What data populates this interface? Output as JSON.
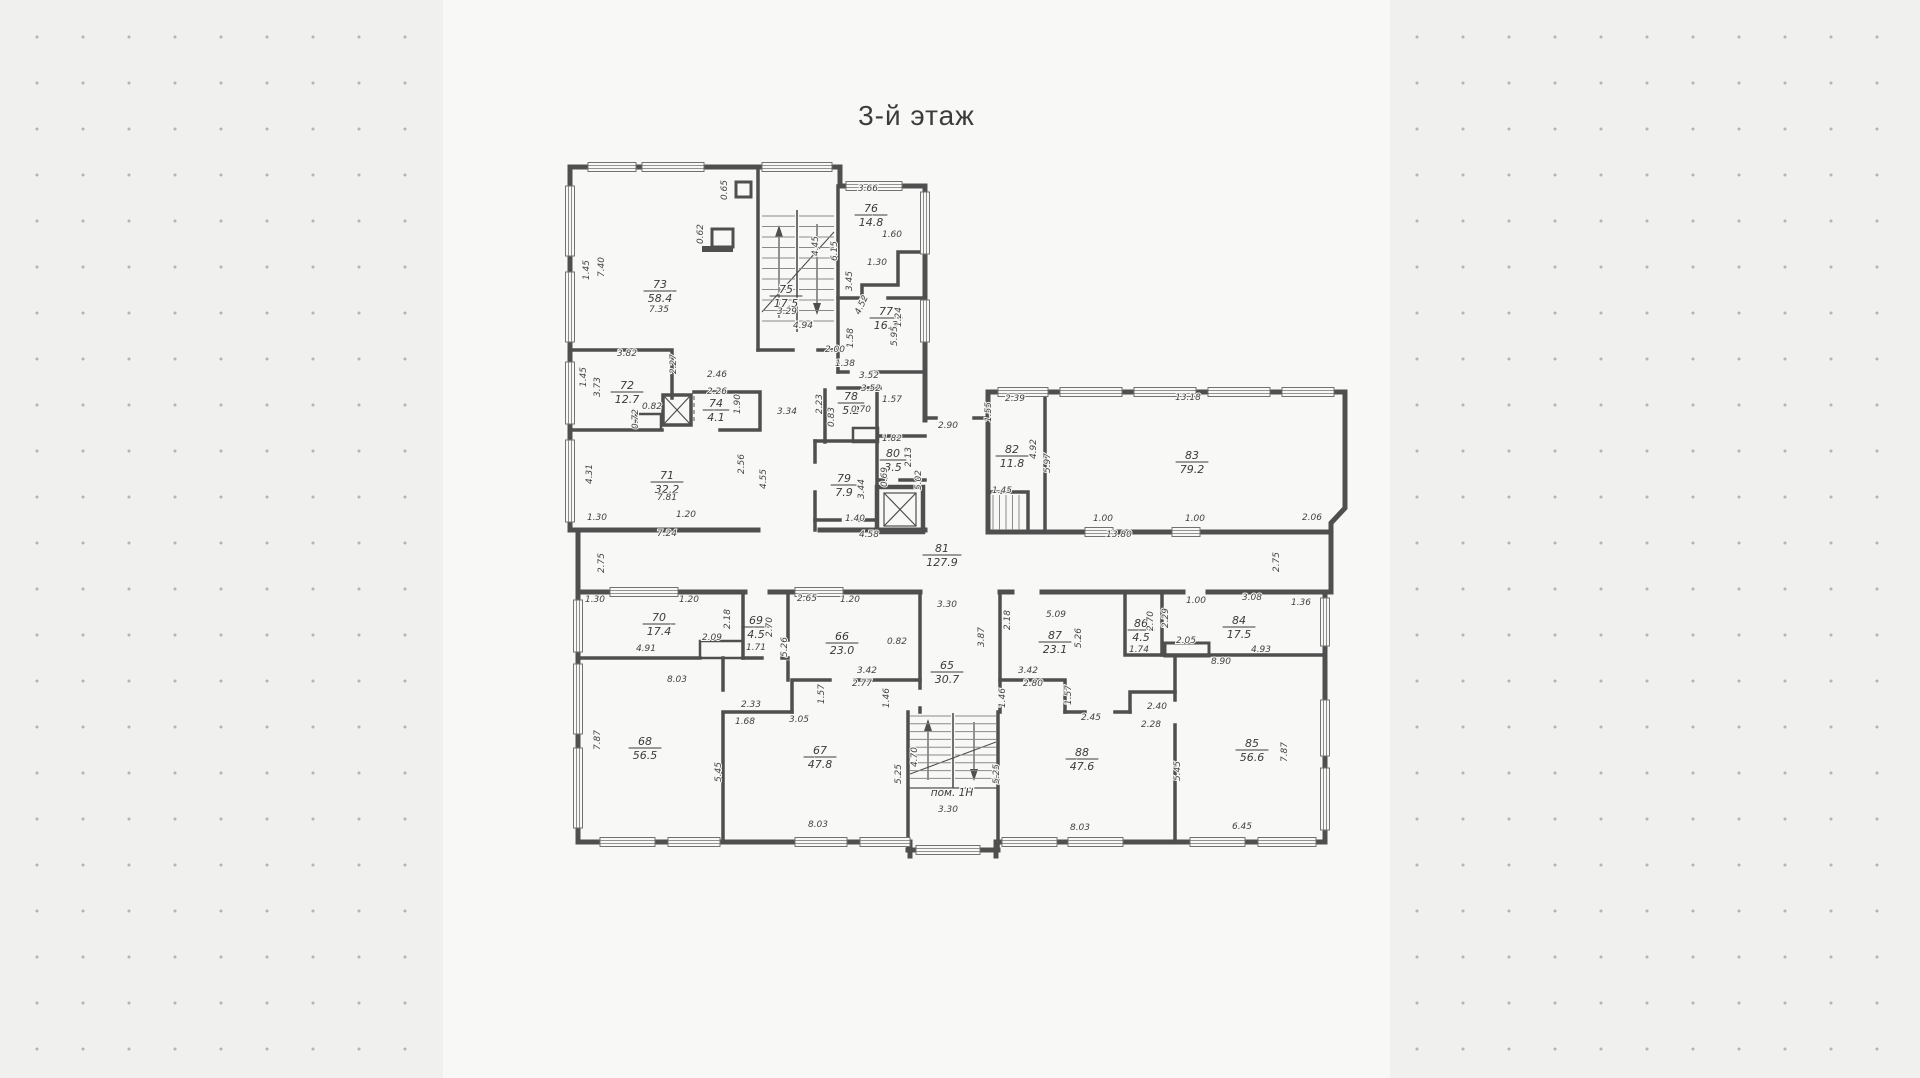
{
  "title": "3-й этаж",
  "colors": {
    "background": "#f0f0ee",
    "sheet": "#f8f8f7",
    "wall": "#4f4f4f",
    "thin_line": "#8a8a86",
    "text": "#45423e",
    "dot": "#b6b6b1"
  },
  "plan": {
    "rooms": [
      {
        "number": "73",
        "area": "58.4",
        "x": 660,
        "y": 288
      },
      {
        "number": "75",
        "area": "17.5",
        "x": 786,
        "y": 293
      },
      {
        "number": "76",
        "area": "14.8",
        "x": 871,
        "y": 212
      },
      {
        "number": "77",
        "area": "16.3",
        "x": 886,
        "y": 315
      },
      {
        "number": "72",
        "area": "12.7",
        "x": 627,
        "y": 389
      },
      {
        "number": "74",
        "area": "4.1",
        "x": 716,
        "y": 407
      },
      {
        "number": "71",
        "area": "32.2",
        "x": 667,
        "y": 479
      },
      {
        "number": "78",
        "area": "5.2",
        "x": 851,
        "y": 400
      },
      {
        "number": "80",
        "area": "3.5",
        "x": 893,
        "y": 457
      },
      {
        "number": "79",
        "area": "7.9",
        "x": 844,
        "y": 482
      },
      {
        "number": "82",
        "area": "11.8",
        "x": 1012,
        "y": 453
      },
      {
        "number": "83",
        "area": "79.2",
        "x": 1192,
        "y": 459
      },
      {
        "number": "81",
        "area": "127.9",
        "x": 942,
        "y": 552
      },
      {
        "number": "70",
        "area": "17.4",
        "x": 659,
        "y": 621
      },
      {
        "number": "69",
        "area": "4.5",
        "x": 756,
        "y": 624
      },
      {
        "number": "66",
        "area": "23.0",
        "x": 842,
        "y": 640
      },
      {
        "number": "65",
        "area": "30.7",
        "x": 947,
        "y": 669
      },
      {
        "number": "87",
        "area": "23.1",
        "x": 1055,
        "y": 639
      },
      {
        "number": "86",
        "area": "4.5",
        "x": 1141,
        "y": 627
      },
      {
        "number": "84",
        "area": "17.5",
        "x": 1239,
        "y": 624
      },
      {
        "number": "68",
        "area": "56.5",
        "x": 645,
        "y": 745
      },
      {
        "number": "67",
        "area": "47.8",
        "x": 820,
        "y": 754
      },
      {
        "number": "88",
        "area": "47.6",
        "x": 1082,
        "y": 756
      },
      {
        "number": "85",
        "area": "56.6",
        "x": 1252,
        "y": 747
      }
    ],
    "stair_room": {
      "label": "пом. 1Н",
      "x": 952,
      "y": 796
    },
    "dims": [
      {
        "t": "0.65",
        "x": 727,
        "y": 190,
        "r": -90
      },
      {
        "t": "0.62",
        "x": 703,
        "y": 234,
        "r": -90
      },
      {
        "t": "7.35",
        "x": 659,
        "y": 312
      },
      {
        "t": "3.82",
        "x": 627,
        "y": 356
      },
      {
        "t": "1.45",
        "x": 589,
        "y": 270,
        "r": -90
      },
      {
        "t": "7.40",
        "x": 604,
        "y": 267,
        "r": -90
      },
      {
        "t": "3.29",
        "x": 787,
        "y": 314
      },
      {
        "t": "4.94",
        "x": 803,
        "y": 328
      },
      {
        "t": "3.66",
        "x": 868,
        "y": 191
      },
      {
        "t": "1.60",
        "x": 892,
        "y": 237
      },
      {
        "t": "6.15",
        "x": 837,
        "y": 251,
        "r": -90
      },
      {
        "t": "1.30",
        "x": 877,
        "y": 265
      },
      {
        "t": "3.45",
        "x": 852,
        "y": 281,
        "r": -90
      },
      {
        "t": "4.52",
        "x": 864,
        "y": 306,
        "r": -65
      },
      {
        "t": "1.24",
        "x": 901,
        "y": 317,
        "r": -90
      },
      {
        "t": "5.95",
        "x": 897,
        "y": 336,
        "r": -90
      },
      {
        "t": "4.45",
        "x": 818,
        "y": 246,
        "r": -90
      },
      {
        "t": "1.45",
        "x": 586,
        "y": 377,
        "r": -90
      },
      {
        "t": "3.73",
        "x": 600,
        "y": 387,
        "r": -90
      },
      {
        "t": "2.27",
        "x": 676,
        "y": 364,
        "r": -90
      },
      {
        "t": "2.46",
        "x": 717,
        "y": 377
      },
      {
        "t": "2.26",
        "x": 717,
        "y": 394
      },
      {
        "t": "1.90",
        "x": 740,
        "y": 404,
        "r": -90
      },
      {
        "t": "0.82",
        "x": 652,
        "y": 409
      },
      {
        "t": "0.72",
        "x": 638,
        "y": 419,
        "r": -90
      },
      {
        "t": "3.34",
        "x": 787,
        "y": 414
      },
      {
        "t": "2.23",
        "x": 822,
        "y": 404,
        "r": -90
      },
      {
        "t": "2.00",
        "x": 835,
        "y": 352
      },
      {
        "t": "1.38",
        "x": 845,
        "y": 366
      },
      {
        "t": "1.58",
        "x": 853,
        "y": 338,
        "r": -90
      },
      {
        "t": "3.52",
        "x": 869,
        "y": 378
      },
      {
        "t": "3.52",
        "x": 871,
        "y": 391
      },
      {
        "t": "1.57",
        "x": 892,
        "y": 402
      },
      {
        "t": "0.70",
        "x": 861,
        "y": 412
      },
      {
        "t": "0.83",
        "x": 834,
        "y": 417,
        "r": -90
      },
      {
        "t": "1.82",
        "x": 892,
        "y": 441
      },
      {
        "t": "2.13",
        "x": 911,
        "y": 457,
        "r": -90
      },
      {
        "t": "0.69",
        "x": 887,
        "y": 477,
        "r": -90
      },
      {
        "t": "5.02",
        "x": 921,
        "y": 480,
        "r": -90
      },
      {
        "t": "3.44",
        "x": 864,
        "y": 489,
        "r": -90
      },
      {
        "t": "1.40",
        "x": 855,
        "y": 521
      },
      {
        "t": "4.58",
        "x": 869,
        "y": 537
      },
      {
        "t": "2.90",
        "x": 948,
        "y": 428
      },
      {
        "t": "1.55",
        "x": 991,
        "y": 412,
        "r": -90
      },
      {
        "t": "4.31",
        "x": 592,
        "y": 474,
        "r": -90
      },
      {
        "t": "7.81",
        "x": 667,
        "y": 500
      },
      {
        "t": "1.30",
        "x": 597,
        "y": 520
      },
      {
        "t": "1.20",
        "x": 686,
        "y": 517
      },
      {
        "t": "7.24",
        "x": 667,
        "y": 536
      },
      {
        "t": "2.56",
        "x": 744,
        "y": 464,
        "r": -90
      },
      {
        "t": "4.55",
        "x": 766,
        "y": 479,
        "r": -90
      },
      {
        "t": "2.75",
        "x": 604,
        "y": 563,
        "r": -90
      },
      {
        "t": "2.39",
        "x": 1015,
        "y": 401
      },
      {
        "t": "13.18",
        "x": 1188,
        "y": 400
      },
      {
        "t": "4.92",
        "x": 1036,
        "y": 449,
        "r": -90
      },
      {
        "t": "5.97",
        "x": 1050,
        "y": 463,
        "r": -90
      },
      {
        "t": "1.45",
        "x": 1002,
        "y": 493
      },
      {
        "t": "1.00",
        "x": 1103,
        "y": 521
      },
      {
        "t": "1.00",
        "x": 1195,
        "y": 521
      },
      {
        "t": "13.80",
        "x": 1119,
        "y": 537
      },
      {
        "t": "2.06",
        "x": 1312,
        "y": 520
      },
      {
        "t": "2.75",
        "x": 1279,
        "y": 562,
        "r": -90
      },
      {
        "t": "1.30",
        "x": 595,
        "y": 602
      },
      {
        "t": "1.20",
        "x": 689,
        "y": 602
      },
      {
        "t": "2.65",
        "x": 807,
        "y": 601
      },
      {
        "t": "1.20",
        "x": 850,
        "y": 602
      },
      {
        "t": "3.30",
        "x": 947,
        "y": 607
      },
      {
        "t": "2.18",
        "x": 730,
        "y": 619,
        "r": -90
      },
      {
        "t": "2.09",
        "x": 712,
        "y": 640
      },
      {
        "t": "4.91",
        "x": 646,
        "y": 651
      },
      {
        "t": "8.03",
        "x": 677,
        "y": 682
      },
      {
        "t": "2.70",
        "x": 772,
        "y": 627,
        "r": -90
      },
      {
        "t": "1.71",
        "x": 756,
        "y": 650
      },
      {
        "t": "5.26",
        "x": 787,
        "y": 647,
        "r": -90
      },
      {
        "t": "0.82",
        "x": 897,
        "y": 644
      },
      {
        "t": "1.57",
        "x": 824,
        "y": 694,
        "r": -90
      },
      {
        "t": "3.42",
        "x": 867,
        "y": 673
      },
      {
        "t": "2.77",
        "x": 862,
        "y": 686
      },
      {
        "t": "3.87",
        "x": 984,
        "y": 637,
        "r": -90
      },
      {
        "t": "1.46",
        "x": 889,
        "y": 698,
        "r": -90
      },
      {
        "t": "1.46",
        "x": 1005,
        "y": 698,
        "r": -90
      },
      {
        "t": "2.33",
        "x": 751,
        "y": 707
      },
      {
        "t": "1.68",
        "x": 745,
        "y": 724
      },
      {
        "t": "3.05",
        "x": 799,
        "y": 722
      },
      {
        "t": "7.87",
        "x": 600,
        "y": 740,
        "r": -90
      },
      {
        "t": "5.45",
        "x": 721,
        "y": 772,
        "r": -90
      },
      {
        "t": "5.25",
        "x": 901,
        "y": 774,
        "r": -90
      },
      {
        "t": "4.70",
        "x": 917,
        "y": 757,
        "r": -90
      },
      {
        "t": "5.25",
        "x": 999,
        "y": 774,
        "r": -90
      },
      {
        "t": "8.03",
        "x": 818,
        "y": 827
      },
      {
        "t": "3.30",
        "x": 948,
        "y": 812
      },
      {
        "t": "5.09",
        "x": 1056,
        "y": 617
      },
      {
        "t": "2.18",
        "x": 1010,
        "y": 620,
        "r": -90
      },
      {
        "t": "5.26",
        "x": 1081,
        "y": 638,
        "r": -90
      },
      {
        "t": "3.42",
        "x": 1028,
        "y": 673
      },
      {
        "t": "2.80",
        "x": 1033,
        "y": 686
      },
      {
        "t": "1.57",
        "x": 1071,
        "y": 695,
        "r": -90
      },
      {
        "t": "2.45",
        "x": 1091,
        "y": 720
      },
      {
        "t": "2.40",
        "x": 1157,
        "y": 709
      },
      {
        "t": "2.28",
        "x": 1151,
        "y": 727
      },
      {
        "t": "2.70",
        "x": 1153,
        "y": 621,
        "r": -90
      },
      {
        "t": "1.74",
        "x": 1139,
        "y": 652
      },
      {
        "t": "2.29",
        "x": 1168,
        "y": 618,
        "r": -90
      },
      {
        "t": "1.00",
        "x": 1196,
        "y": 603
      },
      {
        "t": "3.08",
        "x": 1252,
        "y": 600
      },
      {
        "t": "1.36",
        "x": 1301,
        "y": 605
      },
      {
        "t": "2.05",
        "x": 1186,
        "y": 643
      },
      {
        "t": "4.93",
        "x": 1261,
        "y": 652
      },
      {
        "t": "8.90",
        "x": 1221,
        "y": 664
      },
      {
        "t": "5.45",
        "x": 1180,
        "y": 771,
        "r": -90
      },
      {
        "t": "7.87",
        "x": 1287,
        "y": 752,
        "r": -90
      },
      {
        "t": "8.03",
        "x": 1080,
        "y": 830
      },
      {
        "t": "6.45",
        "x": 1242,
        "y": 829
      }
    ]
  }
}
